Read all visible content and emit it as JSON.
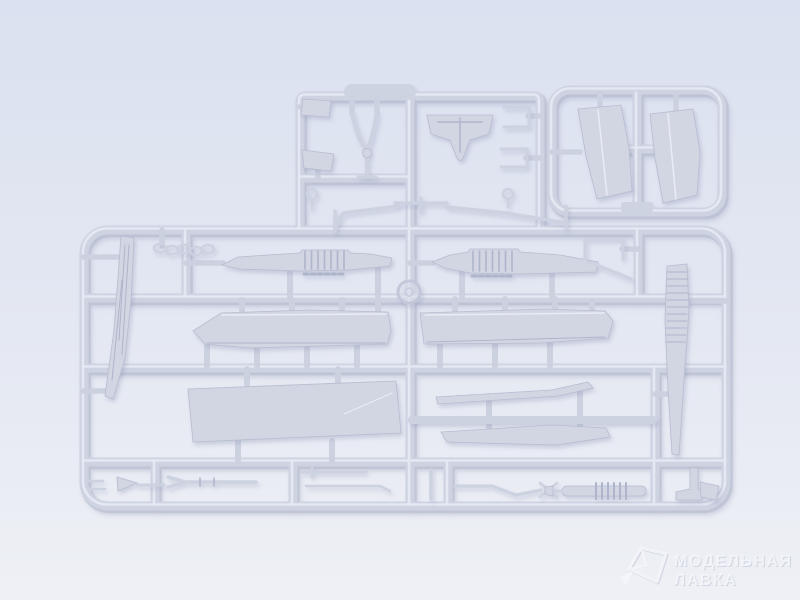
{
  "scene": {
    "subject": "photo of two unpainted light-grey plastic model kit sprues with aircraft parts",
    "sprue_count": 2,
    "mold_mark": "circular ring mark at runner junction"
  },
  "watermark": {
    "logo_icon": "model-shop-crystal-logo",
    "line1": "МОДЕЛЬНАЯ",
    "line2": "ЛАВКА"
  },
  "colors": {
    "background_top": "#dbe1f0",
    "background_mid": "#e3e7f2",
    "background_bottom": "#eef0f5",
    "runner_main": "#ced3e2",
    "runner_shadow": "#b4bacd",
    "runner_highlight": "#e9ecf5",
    "part_fill": "#d2d6e3",
    "part_edge": "#b7bdd0",
    "part_detail": "#aeb5cb",
    "watermark_text": "#f6f7fb"
  }
}
